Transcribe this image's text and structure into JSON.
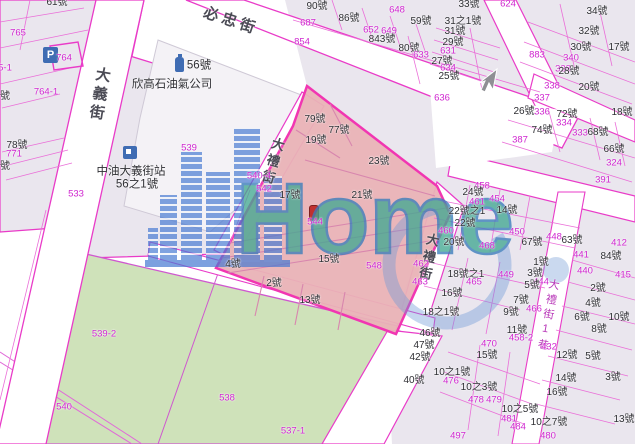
{
  "watermark": {
    "text": "Home"
  },
  "icons": {
    "parking_letter": "P"
  },
  "colors": {
    "magenta_line": "#e93bc8",
    "magenta_text": "#cf25cf",
    "black_text": "#2e2e33",
    "pink_parcel": "#e9b2b6",
    "green_parcel": "#cfe2ba",
    "block_fill": "#eae6ee",
    "watermark_teal": "#43a892",
    "watermark_blue": "#4679d2"
  },
  "streets": [
    {
      "name": "必忠街",
      "x": 231,
      "y": 21,
      "rot": 18,
      "vertical": false,
      "size": 15,
      "magenta": false
    },
    {
      "name": "大義街",
      "x": 99,
      "y": 95,
      "rot": 9,
      "vertical": true,
      "size": 15,
      "magenta": false
    },
    {
      "name": "大禮街",
      "x": 272,
      "y": 162,
      "rot": 16,
      "vertical": true,
      "size": 13,
      "magenta": false
    },
    {
      "name": "大禮街",
      "x": 428,
      "y": 258,
      "rot": 12,
      "vertical": true,
      "size": 13,
      "magenta": false
    },
    {
      "name": "大禮街1巷",
      "x": 547,
      "y": 316,
      "rot": 10,
      "vertical": true,
      "size": 11,
      "magenta": true
    }
  ],
  "labels": [
    [
      "61號",
      57,
      3,
      "k"
    ],
    [
      "765",
      18,
      33,
      "m"
    ],
    [
      "764",
      64,
      58,
      "m"
    ],
    [
      "5-1",
      5,
      68,
      "m"
    ],
    [
      "764-1",
      46,
      92,
      "m"
    ],
    [
      "號",
      5,
      97,
      "k"
    ],
    [
      "78號",
      17,
      146,
      "k"
    ],
    [
      "771",
      14,
      154,
      "m"
    ],
    [
      "號",
      5,
      167,
      "k"
    ],
    [
      "533",
      76,
      194,
      "m"
    ],
    [
      "56號",
      199,
      66,
      "kb"
    ],
    [
      "欣高石油氣公司",
      172,
      85,
      "kb"
    ],
    [
      "539",
      189,
      148,
      "m"
    ],
    [
      "中油大義街站",
      131,
      172,
      "kb"
    ],
    [
      "56之1號",
      137,
      185,
      "kb"
    ],
    [
      "687",
      308,
      23,
      "m"
    ],
    [
      "90號",
      317,
      7,
      "k"
    ],
    [
      "86號",
      349,
      19,
      "k"
    ],
    [
      "652",
      371,
      30,
      "m"
    ],
    [
      "649",
      389,
      31,
      "m"
    ],
    [
      "843號",
      382,
      40,
      "k"
    ],
    [
      "854",
      302,
      42,
      "m"
    ],
    [
      "33號",
      469,
      5,
      "k"
    ],
    [
      "624",
      508,
      4,
      "m"
    ],
    [
      "648",
      397,
      10,
      "m"
    ],
    [
      "59號",
      421,
      22,
      "k"
    ],
    [
      "31之1號",
      463,
      22,
      "k"
    ],
    [
      "31號",
      455,
      32,
      "k"
    ],
    [
      "29號",
      453,
      43,
      "k"
    ],
    [
      "631",
      448,
      51,
      "m"
    ],
    [
      "80號",
      409,
      49,
      "k"
    ],
    [
      "633",
      421,
      55,
      "m"
    ],
    [
      "27號",
      442,
      62,
      "k"
    ],
    [
      "634",
      448,
      68,
      "m"
    ],
    [
      "25號",
      449,
      77,
      "k"
    ],
    [
      "636",
      442,
      98,
      "m"
    ],
    [
      "34號",
      597,
      12,
      "k"
    ],
    [
      "32號",
      589,
      32,
      "k"
    ],
    [
      "30號",
      581,
      48,
      "k"
    ],
    [
      "17號",
      619,
      48,
      "k"
    ],
    [
      "883",
      537,
      55,
      "m"
    ],
    [
      "340",
      571,
      58,
      "m"
    ],
    [
      "338",
      563,
      69,
      "m"
    ],
    [
      "28號",
      569,
      72,
      "k"
    ],
    [
      "338",
      552,
      86,
      "m"
    ],
    [
      "20號",
      589,
      88,
      "k"
    ],
    [
      "337",
      542,
      98,
      "m"
    ],
    [
      "26號",
      524,
      112,
      "k"
    ],
    [
      "336",
      542,
      112,
      "m"
    ],
    [
      "72號",
      567,
      115,
      "k"
    ],
    [
      "18號",
      622,
      113,
      "k"
    ],
    [
      "334",
      564,
      123,
      "m"
    ],
    [
      "74號",
      542,
      131,
      "k"
    ],
    [
      "387",
      520,
      140,
      "m"
    ],
    [
      "333",
      580,
      133,
      "m"
    ],
    [
      "68號",
      598,
      133,
      "k"
    ],
    [
      "66號",
      614,
      150,
      "k"
    ],
    [
      "324",
      614,
      163,
      "m"
    ],
    [
      "391",
      603,
      180,
      "m"
    ],
    [
      "79號",
      315,
      120,
      "k"
    ],
    [
      "77號",
      339,
      131,
      "k"
    ],
    [
      "19號",
      316,
      141,
      "k"
    ],
    [
      "23號",
      379,
      162,
      "k"
    ],
    [
      "540-4",
      259,
      176,
      "m"
    ],
    [
      "542",
      264,
      189,
      "m"
    ],
    [
      "17號",
      290,
      196,
      "k"
    ],
    [
      "21號",
      362,
      196,
      "k"
    ],
    [
      "544",
      315,
      222,
      "m"
    ],
    [
      "4號",
      233,
      265,
      "k"
    ],
    [
      "15號",
      329,
      260,
      "k"
    ],
    [
      "548",
      374,
      266,
      "m"
    ],
    [
      "2號",
      274,
      284,
      "k"
    ],
    [
      "13號",
      310,
      301,
      "k"
    ],
    [
      "458",
      482,
      186,
      "m"
    ],
    [
      "24號",
      473,
      193,
      "k"
    ],
    [
      "461",
      477,
      202,
      "m"
    ],
    [
      "454",
      497,
      199,
      "m"
    ],
    [
      "22號之1",
      467,
      212,
      "k"
    ],
    [
      "14號",
      507,
      211,
      "k"
    ],
    [
      "22號",
      465,
      224,
      "k"
    ],
    [
      "460",
      446,
      231,
      "m"
    ],
    [
      "20號",
      454,
      243,
      "k"
    ],
    [
      "468",
      487,
      246,
      "m"
    ],
    [
      "450",
      517,
      232,
      "m"
    ],
    [
      "67號",
      532,
      243,
      "k"
    ],
    [
      "448",
      554,
      237,
      "m"
    ],
    [
      "63號",
      572,
      241,
      "k"
    ],
    [
      "412",
      619,
      243,
      "m"
    ],
    [
      "441",
      581,
      255,
      "m"
    ],
    [
      "84號",
      611,
      257,
      "k"
    ],
    [
      "440",
      585,
      271,
      "m"
    ],
    [
      "415",
      623,
      275,
      "m"
    ],
    [
      "462",
      421,
      264,
      "m"
    ],
    [
      "18號之1",
      466,
      275,
      "k"
    ],
    [
      "449",
      506,
      275,
      "m"
    ],
    [
      "465",
      474,
      282,
      "m"
    ],
    [
      "463",
      420,
      282,
      "m"
    ],
    [
      "16號",
      452,
      294,
      "k"
    ],
    [
      "1號",
      541,
      263,
      "k"
    ],
    [
      "3號",
      535,
      274,
      "k"
    ],
    [
      "444",
      541,
      282,
      "m"
    ],
    [
      "5號",
      532,
      286,
      "k"
    ],
    [
      "7號",
      521,
      301,
      "k"
    ],
    [
      "466",
      534,
      309,
      "m"
    ],
    [
      "9號",
      511,
      313,
      "k"
    ],
    [
      "11號",
      517,
      331,
      "k"
    ],
    [
      "458-2",
      521,
      338,
      "m"
    ],
    [
      "18之1號",
      441,
      313,
      "k"
    ],
    [
      "46號",
      430,
      334,
      "k"
    ],
    [
      "47號",
      424,
      346,
      "k"
    ],
    [
      "42號",
      420,
      358,
      "k"
    ],
    [
      "40號",
      414,
      381,
      "k"
    ],
    [
      "2號",
      598,
      289,
      "k"
    ],
    [
      "4號",
      593,
      304,
      "k"
    ],
    [
      "6號",
      582,
      318,
      "k"
    ],
    [
      "10號",
      619,
      318,
      "k"
    ],
    [
      "8號",
      599,
      330,
      "k"
    ],
    [
      "5號",
      593,
      357,
      "k"
    ],
    [
      "12號",
      567,
      356,
      "k"
    ],
    [
      "3號",
      613,
      378,
      "k"
    ],
    [
      "14號",
      566,
      379,
      "k"
    ],
    [
      "16號",
      557,
      393,
      "k"
    ],
    [
      "13號",
      624,
      420,
      "k"
    ],
    [
      "432",
      549,
      347,
      "m"
    ],
    [
      "15號",
      487,
      356,
      "k"
    ],
    [
      "10之1號",
      452,
      373,
      "k"
    ],
    [
      "476",
      451,
      381,
      "m"
    ],
    [
      "10之3號",
      479,
      388,
      "k"
    ],
    [
      "478",
      476,
      400,
      "m"
    ],
    [
      "479",
      494,
      400,
      "m"
    ],
    [
      "10之5號",
      520,
      410,
      "k"
    ],
    [
      "481",
      509,
      419,
      "m"
    ],
    [
      "10之7號",
      549,
      423,
      "k"
    ],
    [
      "484",
      518,
      427,
      "m"
    ],
    [
      "480",
      548,
      436,
      "m"
    ],
    [
      "497",
      458,
      436,
      "m"
    ],
    [
      "539-2",
      104,
      334,
      "m"
    ],
    [
      "540",
      64,
      407,
      "m"
    ],
    [
      "538",
      227,
      398,
      "m"
    ],
    [
      "537-1",
      293,
      431,
      "m"
    ],
    [
      "470",
      489,
      344,
      "m"
    ]
  ]
}
